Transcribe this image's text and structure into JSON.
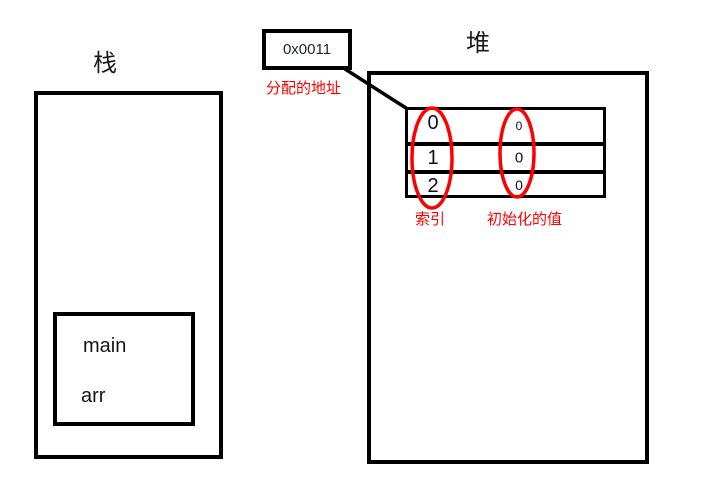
{
  "stack": {
    "label": "栈",
    "frame": {
      "function_name": "main",
      "variable_name": "arr"
    }
  },
  "address_callout": {
    "value": "0x0011",
    "caption": "分配的地址"
  },
  "heap": {
    "label": "堆",
    "array_table": {
      "rows": [
        {
          "index": "0",
          "value": "0"
        },
        {
          "index": "1",
          "value": "0"
        },
        {
          "index": "2",
          "value": "0"
        }
      ],
      "index_caption": "索引",
      "values_caption": "初始化的值"
    }
  },
  "colors": {
    "ink": "#000000",
    "annotation_red": "#ff0000"
  }
}
